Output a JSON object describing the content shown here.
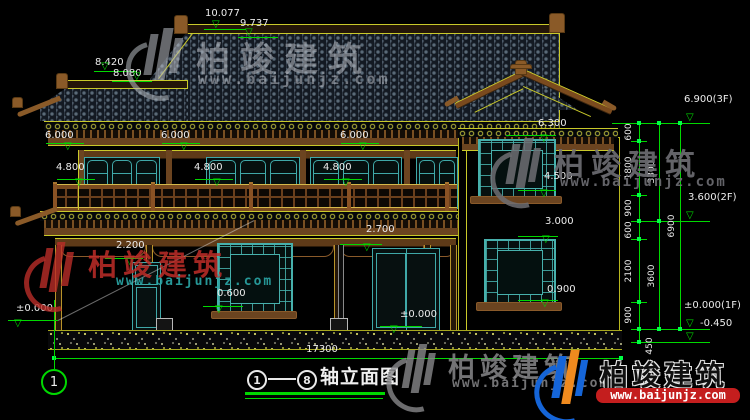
{
  "drawing_type": "house elevation CAD drawing",
  "marks": {
    "m10077": "10.077",
    "m9737": "9.737",
    "m8420": "8.420",
    "m8080": "8.080",
    "m6000a": "6.000",
    "m6000b": "6.000",
    "m6000c": "6.000",
    "m4800a": "4.800",
    "m4800b": "4.800",
    "m4800c": "4.800",
    "m6300": "6.300",
    "m4500": "4.500",
    "m3000": "3.000",
    "m0900": "0.900",
    "m2200": "2.200",
    "m0600": "0.600",
    "m2700": "2.700",
    "mzero_door": "±0.000",
    "mzero_left": "±0.000"
  },
  "levels": {
    "f3": "6.900(3F)",
    "f2": "3.600(2F)",
    "f1": "±0.000(1F)",
    "base": "-0.450"
  },
  "chain": {
    "s600a": "600",
    "s1800": "1800",
    "s900a": "900",
    "s600b": "600",
    "s2100": "2100",
    "s900b": "900",
    "s450": "450",
    "sub3300": "3300",
    "sub3600": "3600",
    "total6900": "6900"
  },
  "footer": {
    "total_width": "17300",
    "axis_bubble": "1",
    "axis_start": "1",
    "axis_end": "8",
    "title": "轴立面图"
  },
  "watermark": {
    "brand": "柏竣建筑",
    "url": "www.baijunjz.com"
  },
  "icons": {
    "level_marker": "▽"
  },
  "colors": {
    "dim_green": "#00d800",
    "line_yellow": "#c9c92a",
    "wood_brown": "#7a4a1e",
    "frame_teal": "#47b0ac",
    "wm_red": "#c03028",
    "wm_teal": "#2fa6a6",
    "logo_blue": "#1565d8",
    "logo_orange": "#f08a1e",
    "url_strip_red": "#c41e1e"
  }
}
